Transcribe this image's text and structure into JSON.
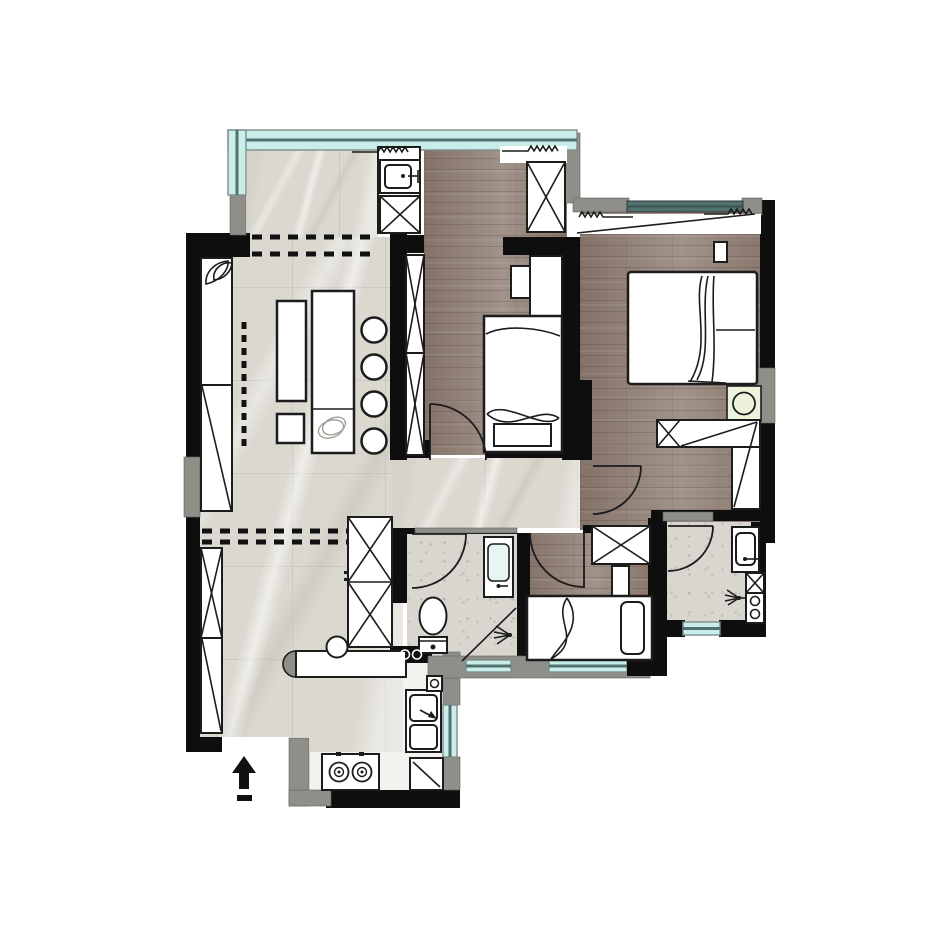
{
  "title": "apartment-floor-plan",
  "canvas": {
    "width": 932,
    "height": 932
  },
  "colors": {
    "wall": "#0e0e0e",
    "trim": "#8f8f89",
    "marble": "#dbd8d0",
    "wood": "#95847a",
    "tile": "#d8d6cf",
    "glass": "#c9eeea",
    "window_frame": "#51716e",
    "lamp": "#edf3da",
    "furniture": "#ffffff",
    "line": "#1c1c1c",
    "kitchen_floor": "#f3f2ef",
    "page_bg": "#ffffff"
  },
  "symbols": {
    "entry_arrow": "filled triangle arrow pointing up at entrance",
    "window": "cyan double-line band",
    "wardrobe": "rectangle with X cross",
    "door": "quarter-circle swing arc",
    "curtain": "zigzag squiggle line"
  }
}
